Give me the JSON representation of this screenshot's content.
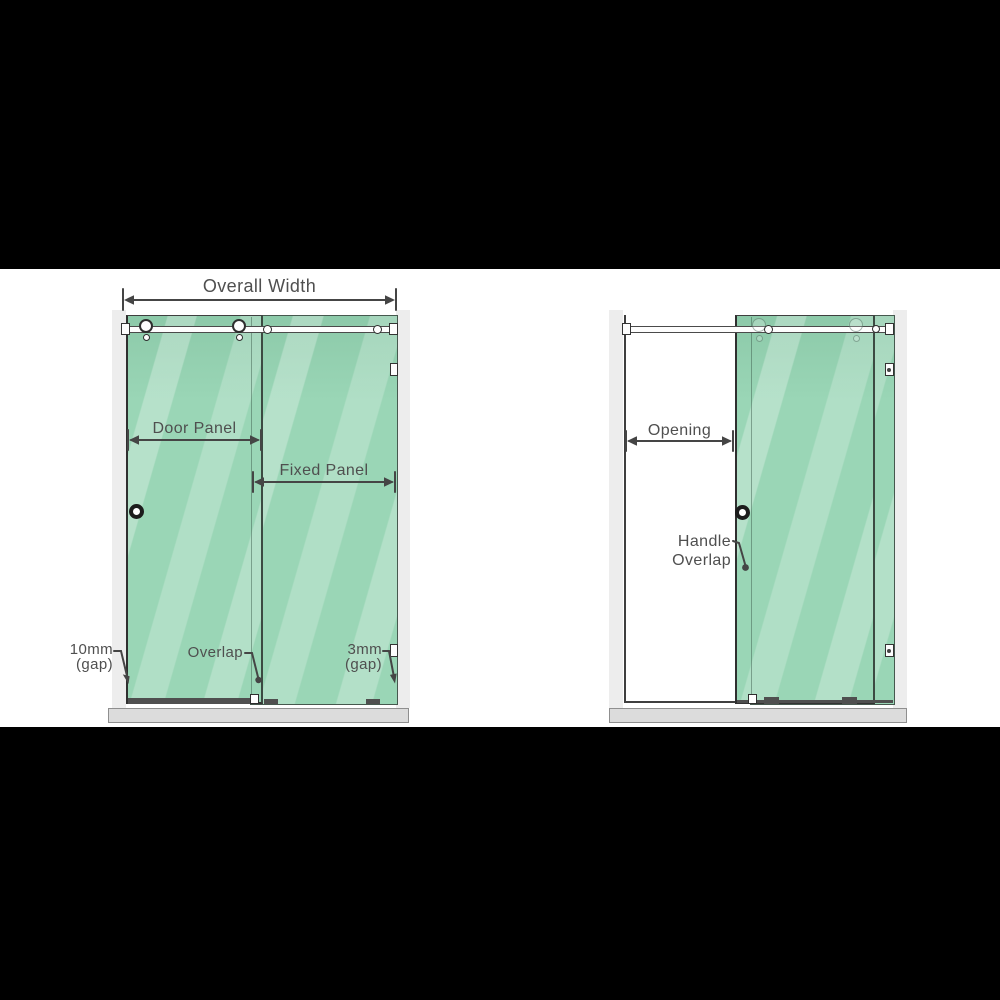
{
  "colors": {
    "glass_green": "#9ad6b6",
    "glass_highlight": "#cdeeda",
    "hardware_outline": "#3f3f3f",
    "label_text": "#4f4f4f",
    "tray_gray": "#dcdcdc",
    "wall_gray": "#ededed",
    "background": "#000000",
    "stage": "#ffffff"
  },
  "left_diagram": {
    "overall_width_label": "Overall Width",
    "door_panel_label": "Door Panel",
    "fixed_panel_label": "Fixed Panel",
    "left_gap_line1": "10mm",
    "left_gap_line2": "(gap)",
    "overlap_label": "Overlap",
    "right_gap_line1": "3mm",
    "right_gap_line2": "(gap)"
  },
  "right_diagram": {
    "opening_label": "Opening",
    "handle_line1": "Handle",
    "handle_line2": "Overlap"
  }
}
